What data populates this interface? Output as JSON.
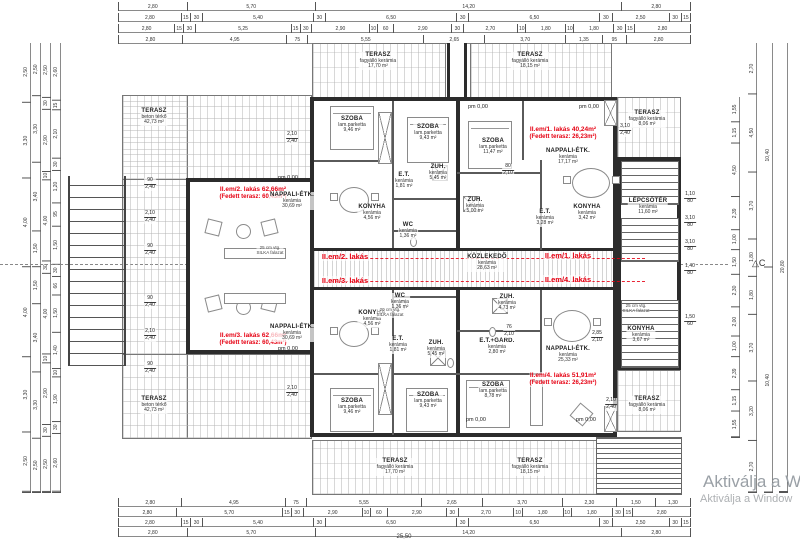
{
  "meta": {
    "watermark1": "Aktiválja a Win",
    "watermark2": "Aktiválja a Window",
    "section_marker": "△C",
    "total_width": "25,50",
    "pm_label": "pm 0,00",
    "red_color": "#e60012",
    "line_color": "#2c2c2c"
  },
  "apartments": [
    {
      "line1": "II.em/2. lakás 62,66m²",
      "line2": "(Fedett terasz: 60,43m²)",
      "tag": "II.em/2. lakás"
    },
    {
      "line1": "II.em/1. lakás 40,24m²",
      "line2": "(Fedett terasz: 26,23m²)",
      "tag": "II.em/1. lakás"
    },
    {
      "line1": "II.em/3. lakás 62,66m²",
      "line2": "(Fedett terasz: 60,43m²)",
      "tag": "II.em/3. lakás"
    },
    {
      "line1": "II.em/4. lakás 51,91m²",
      "line2": "(Fedett terasz: 26,23m²)",
      "tag": "II.em/4. lakás"
    }
  ],
  "rooms": [
    {
      "n": "TERASZ",
      "m": "beton térkő",
      "a": "42,73 m²"
    },
    {
      "n": "TERASZ",
      "m": "beton térkő",
      "a": "42,73 m²"
    },
    {
      "n": "SZOBA",
      "m": "lam.parketta",
      "a": "9,46 m²"
    },
    {
      "n": "KONYHA",
      "m": "kerámia",
      "a": "4,56 m²"
    },
    {
      "n": "E.T.",
      "m": "kerámia",
      "a": "1,81 m²"
    },
    {
      "n": "ZUH.",
      "m": "kerámia",
      "a": "5,45 m²"
    },
    {
      "n": "WC",
      "m": "kerámia",
      "a": "1,36 m²"
    },
    {
      "n": "NAPPALI-ÉTK.",
      "m": "kerámia",
      "a": "30,69 m²"
    },
    {
      "n": "SZOBA",
      "m": "lam.parketta",
      "a": "9,43 m²"
    },
    {
      "n": "SZOBA",
      "m": "lam.parketta",
      "a": "11,47 m²"
    },
    {
      "n": "NAPPALI-ÉTK.",
      "m": "kerámia",
      "a": "17,17 m²"
    },
    {
      "n": "ZUH.",
      "m": "kerámia",
      "a": "5,00 m²"
    },
    {
      "n": "E.T.",
      "m": "kerámia",
      "a": "3,28 m²"
    },
    {
      "n": "KONYHA",
      "m": "kerámia",
      "a": "3,42 m²"
    },
    {
      "n": "TERASZ",
      "m": "fagyálló kerámia",
      "a": "17,70 m²"
    },
    {
      "n": "TERASZ",
      "m": "fagyálló kerámia",
      "a": "18,15 m²"
    },
    {
      "n": "TERASZ",
      "m": "fagyálló kerámia",
      "a": "8,06 m²"
    },
    {
      "n": "LÉPCSŐTÉR",
      "m": "kerámia",
      "a": "11,60 m²"
    },
    {
      "n": "KÖZLEKEDŐ",
      "m": "kerámia",
      "a": "28,63 m²"
    },
    {
      "n": "WC",
      "m": "kerámia",
      "a": "1,36 m²"
    },
    {
      "n": "E.T.",
      "m": "kerámia",
      "a": "1,81 m²"
    },
    {
      "n": "ZUH.",
      "m": "kerámia",
      "a": "5,45 m²"
    },
    {
      "n": "KONYHA",
      "m": "kerámia",
      "a": "4,56 m²"
    },
    {
      "n": "NAPPALI-ÉTK.",
      "m": "kerámia",
      "a": "30,69 m²"
    },
    {
      "n": "SZOBA",
      "m": "lam.parketta",
      "a": "9,46 m²"
    },
    {
      "n": "ZUH.",
      "m": "kerámia",
      "a": "4,73 m²"
    },
    {
      "n": "E.T.+GARD.",
      "m": "kerámia",
      "a": "2,80 m²"
    },
    {
      "n": "NAPPALI-ÉTK.",
      "m": "kerámia",
      "a": "25,33 m²"
    },
    {
      "n": "SZOBA",
      "m": "lam.parketta",
      "a": "9,43 m²"
    },
    {
      "n": "SZOBA",
      "m": "lam.parketta",
      "a": "8,78 m²"
    },
    {
      "n": "KONYHA",
      "m": "kerámia",
      "a": "3,67 m²"
    },
    {
      "n": "TERASZ",
      "m": "fagyálló kerámia",
      "a": "17,70 m²"
    },
    {
      "n": "TERASZ",
      "m": "fagyálló kerámia",
      "a": "18,15 m²"
    },
    {
      "n": "TERASZ",
      "m": "fagyálló kerámia",
      "a": "8,06 m²"
    }
  ],
  "notes": [
    {
      "a": "25 cm vtg.",
      "b": "SILKA falazat"
    },
    {
      "a": "25 cm vtg.",
      "b": "SILKA falazat"
    },
    {
      "a": "20 cm vtg.",
      "b": "SILKA falazat"
    }
  ],
  "dims": [
    {
      "a": "2,10",
      "b": "2,40"
    },
    {
      "a": "90",
      "b": "2,40"
    },
    {
      "a": "2,10",
      "b": "2,40"
    },
    {
      "a": "90",
      "b": "2,40"
    },
    {
      "a": "90",
      "b": "2,40"
    },
    {
      "a": "2,10",
      "b": "2,40"
    },
    {
      "a": "90",
      "b": "2,40"
    },
    {
      "a": "2,10",
      "b": "2,40"
    },
    {
      "a": "1,10",
      "b": "80"
    },
    {
      "a": "3,10",
      "b": "80"
    },
    {
      "a": "3,10",
      "b": "80"
    },
    {
      "a": "1,40",
      "b": "80"
    },
    {
      "a": "2,85",
      "b": "2,10"
    },
    {
      "a": "1,50",
      "b": "60"
    },
    {
      "a": "2,10",
      "b": "2,40"
    },
    {
      "a": "3,10",
      "b": "2,40"
    },
    {
      "a": "80",
      "b": "2,10"
    },
    {
      "a": "76",
      "b": "2,10"
    }
  ],
  "chains": {
    "t1": [
      "2,80",
      "5,70",
      "14,20",
      "2,80"
    ],
    "t2": [
      "2,80",
      "15",
      "30",
      "5,40",
      "30",
      "6,50",
      "30",
      "6,50",
      "30",
      "2,50",
      "30",
      "15"
    ],
    "t3": [
      "2,80",
      "15",
      "30",
      "5,25",
      "15",
      "30",
      "2,90",
      "10",
      "60",
      "2,90",
      "30",
      "2,70",
      "10",
      "1,80",
      "10",
      "1,80",
      "30",
      "15",
      "2,80"
    ],
    "t4": [
      "2,80",
      "4,95",
      "75",
      "5,55",
      "2,65",
      "3,70",
      "1,35",
      "95",
      "2,80"
    ],
    "b1": [
      "2,80",
      "4,95",
      "75",
      "5,55",
      "2,65",
      "3,70",
      "2,30",
      "1,50",
      "1,30"
    ],
    "b2": [
      "2,80",
      "5,70",
      "15",
      "30",
      "2,90",
      "10",
      "60",
      "2,90",
      "30",
      "2,70",
      "10",
      "1,80",
      "10",
      "1,80",
      "30",
      "15",
      "2,80"
    ],
    "b3": [
      "2,80",
      "15",
      "30",
      "5,40",
      "30",
      "6,50",
      "30",
      "6,50",
      "30",
      "2,50",
      "30",
      "15"
    ],
    "b4": [
      "2,80",
      "5,70",
      "14,20",
      "2,80"
    ],
    "l1": [
      "2,50",
      "3,30",
      "4,00",
      "4,00",
      "3,30",
      "2,50"
    ],
    "l2": [
      "2,50",
      "3,30",
      "3,40",
      "1,50",
      "1,50",
      "3,40",
      "3,30",
      "2,50"
    ],
    "l3": [
      "2,50",
      "30",
      "2,90",
      "10",
      "4,00",
      "30",
      "4,00",
      "10",
      "2,90",
      "30",
      "2,50"
    ],
    "l4": [
      "2,60",
      "15",
      "2,10",
      "30",
      "1,20",
      "95",
      "1,50",
      "30",
      "66",
      "1,50",
      "1,40",
      "10",
      "1,90",
      "30",
      "2,60"
    ],
    "r1": [
      "1,55",
      "1,15",
      "4,50",
      "2,39",
      "1,00",
      "1,50",
      "2,30",
      "2,00",
      "1,00",
      "2,39",
      "1,15",
      "1,55"
    ],
    "r2": [
      "2,70",
      "4,50",
      "3,70",
      "1,80",
      "1,80",
      "3,70",
      "3,20",
      "2,70"
    ],
    "r3": [
      "10,40",
      "10,40"
    ],
    "r4": [
      "20,80"
    ]
  }
}
